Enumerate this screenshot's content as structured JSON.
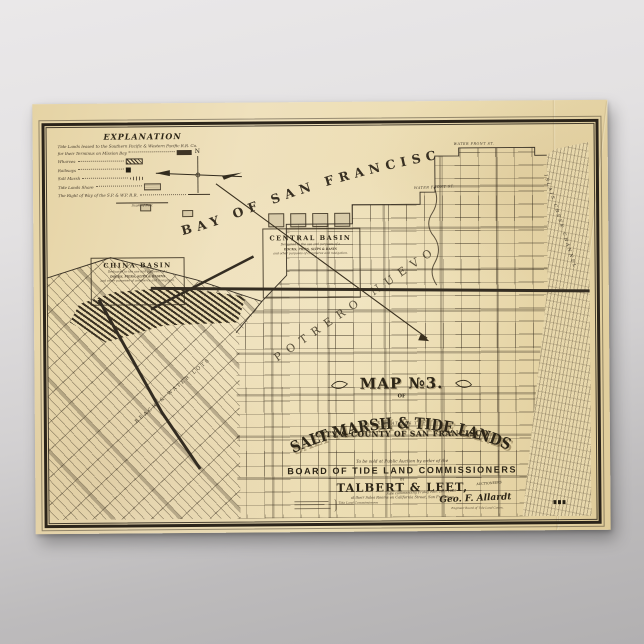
{
  "poster": {
    "explanation": {
      "title": "EXPLANATION",
      "intro": "Tide Lands leased to the Southern Pacific & Western Pacific R.R. Co.",
      "rows": [
        {
          "label": "for their Terminus on Mission Bay",
          "swatch": "solid"
        },
        {
          "label": "Wharves",
          "swatch": "hatch"
        },
        {
          "label": "Railways",
          "swatch": "square"
        },
        {
          "label": "Salt Marsh",
          "swatch": "marsh"
        },
        {
          "label": "Tide Lands Shore",
          "swatch": "shade"
        },
        {
          "label": "The Right of Way of the S.P. & W.P. R.R.",
          "swatch": "line"
        }
      ],
      "scale_note": "Scale of Feet"
    },
    "compass_north": "N",
    "bay_label": "BAY OF SAN FRANCISCO",
    "basins": {
      "central": {
        "title": "CENTRAL BASIN",
        "line1": "Dedicated to the use and purposes of a",
        "line2": "DOCKS, PIERS, SLIPS & BASIN",
        "line3": "and other purposes of commerce and navigation."
      },
      "china": {
        "title": "CHINA BASIN",
        "line1": "Dedicated to the use and purposes of a",
        "line2": "DOCKS, PIERS, SLIPS & BASINS",
        "line3": "and other purposes of commerce and navigation."
      }
    },
    "labels": {
      "potrero": "POTRERO NUEVO",
      "beach_lots": "BEACH & WATER LOTS",
      "water_front_1": "WATER FRONT ST.",
      "water_front_2": "WATER FRONT ST.",
      "islais": "ISLAIS CREEK CHANNEL"
    },
    "title_block": {
      "map_no": "MAP №3.",
      "of": "OF",
      "main": "SALT MARSH & TIDE LANDS",
      "situate": "SITUATE IN THE",
      "city": "CITY & COUNTY OF SAN FRANCISCO",
      "auction": "To be sold at Public Auction by order of the",
      "board": "BOARD OF TIDE LAND COMMISSIONERS",
      "by": "BY",
      "auctioneers": "TALBERT & LEET,",
      "auctioneers_tag": "AUCTIONEERS",
      "salesrooms": "at their Sales Rooms on California Street, San Francisco",
      "sale_date": "Sale commencing Friday Nov. 26th 1869",
      "signature": "Geo. F. Allardt",
      "signature_sub": "Engineer Board of Tide Land Comrs.",
      "commissioners_tag": "Tide Land Commissioners"
    }
  }
}
